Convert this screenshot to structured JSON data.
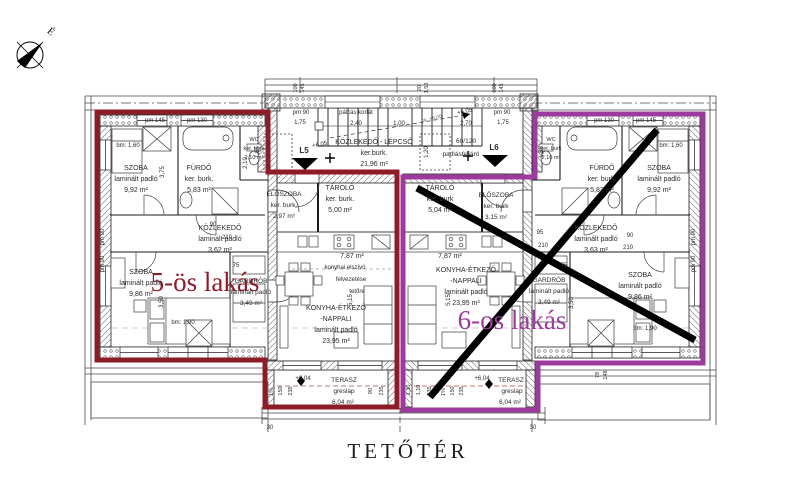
{
  "title": "TETŐTÉR",
  "compass": {
    "north_label": "É"
  },
  "plan": {
    "apartments": [
      {
        "id": "5",
        "label": "5-ös lakás",
        "color": "#8e1c27",
        "crossed_out": false,
        "rooms": [
          {
            "lines": [
              "SZOBA",
              "laminált padló",
              "9,92 m²"
            ],
            "x": 136,
            "y": 170
          },
          {
            "lines": [
              "FÜRDŐ",
              "ker. burk.",
              "5,83 m²"
            ],
            "x": 199,
            "y": 170
          },
          {
            "lines": [
              "WC",
              "ker. burk",
              "2,10 m²"
            ],
            "x": 254,
            "y": 141,
            "s": 5.5,
            "lh": 9
          },
          {
            "lines": [
              "KÖZLEKEDŐ",
              "laminált padló",
              "3,62 m²"
            ],
            "x": 220,
            "y": 230
          },
          {
            "lines": [
              "SZOBA",
              "laminált padló",
              "9,86 m²"
            ],
            "x": 141,
            "y": 274
          },
          {
            "lines": [
              "GARDRÓB",
              "laminált padló",
              "3,49 m²"
            ],
            "x": 251,
            "y": 283,
            "s": 6.5
          },
          {
            "lines": [
              "ELŐSZOBA",
              "ker. burk.",
              "2,97 m²"
            ],
            "x": 284,
            "y": 196,
            "s": 6.5
          },
          {
            "lines": [
              "TÁROLÓ",
              "ker. burk.",
              "5,00 m²"
            ],
            "x": 340,
            "y": 190
          },
          {
            "lines": [
              "KONYHA-ÉTKEZŐ",
              "-NAPPALI",
              "laminált padló",
              "23,95 m²"
            ],
            "x": 336,
            "y": 310
          }
        ]
      },
      {
        "id": "6",
        "label": "6-os lakás",
        "color": "#9c3a9d",
        "crossed_out": true,
        "cross_lines": [
          [
            417,
            188,
            695,
            340
          ],
          [
            657,
            130,
            430,
            397
          ]
        ],
        "rooms": [
          {
            "lines": [
              "WC",
              "ker. burk",
              "2,10 m²"
            ],
            "x": 551,
            "y": 141,
            "s": 5.5,
            "lh": 9
          },
          {
            "lines": [
              "FÜRDŐ",
              "ker. burk.",
              "5,83 m²"
            ],
            "x": 602,
            "y": 170
          },
          {
            "lines": [
              "SZOBA",
              "laminált padló",
              "9,92 m²"
            ],
            "x": 659,
            "y": 170
          },
          {
            "lines": [
              "KÖZLEKEDŐ",
              "laminált padló",
              "3,63 m²"
            ],
            "x": 596,
            "y": 230
          },
          {
            "lines": [
              "TÁROLÓ",
              "ker. burk",
              "5,04 m²"
            ],
            "x": 440,
            "y": 190
          },
          {
            "lines": [
              "ELŐSZOBA",
              "ker. burk",
              "3,15 m²"
            ],
            "x": 496,
            "y": 197,
            "s": 6.5
          },
          {
            "lines": [
              "KONYHA-ÉTKEZŐ",
              "-NAPPALI",
              "laminált padló",
              "23,95 m²"
            ],
            "x": 466,
            "y": 272
          },
          {
            "lines": [
              "GARDRÓB",
              "laminált padló",
              "3,49 m²"
            ],
            "x": 549,
            "y": 282,
            "s": 6.5
          },
          {
            "lines": [
              "SZOBA",
              "laminált padló",
              "9,86 m²"
            ],
            "x": 640,
            "y": 277
          }
        ]
      }
    ],
    "shared": {
      "rooms": [
        {
          "lines": [
            "KÖZLEKEDŐ - LÉPCSŐ",
            "ker.burk.",
            "21,96 m²"
          ],
          "x": 374,
          "y": 144
        }
      ]
    },
    "annotations": [
      {
        "t": "pálcás korlát",
        "x": 356,
        "y": 114,
        "s": 6
      },
      {
        "t": "2,40",
        "x": 356,
        "y": 125,
        "s": 6
      },
      {
        "t": "1,00",
        "x": 399,
        "y": 125,
        "s": 6
      },
      {
        "t": "2,70",
        "x": 466,
        "y": 125,
        "s": 6
      },
      {
        "t": "pm 90",
        "x": 301,
        "y": 114,
        "s": 6
      },
      {
        "t": "1,75",
        "x": 300,
        "y": 124,
        "s": 6
      },
      {
        "t": "pm 90",
        "x": 502,
        "y": 114,
        "s": 6
      },
      {
        "t": "1,75",
        "x": 503,
        "y": 124,
        "s": 6
      },
      {
        "t": "L5",
        "x": 304,
        "y": 153,
        "s": 8,
        "w": 1
      },
      {
        "t": "L6",
        "x": 494,
        "y": 150,
        "s": 8,
        "w": 1
      },
      {
        "t": "+6,05",
        "x": 320,
        "y": 146,
        "s": 6,
        "r": -10
      },
      {
        "t": "+6,05",
        "x": 465,
        "y": 113,
        "s": 6,
        "r": -12
      },
      {
        "t": "pk. +6,00",
        "x": 432,
        "y": 120,
        "s": 5,
        "r": -14,
        "c": "#666666"
      },
      {
        "t": "60/120",
        "x": 466,
        "y": 143,
        "s": 6.5
      },
      {
        "t": "padlásfeljáró",
        "x": 461,
        "y": 156,
        "s": 6.5
      },
      {
        "t": "1,55",
        "x": 259,
        "y": 152,
        "s": 6,
        "r": -90
      },
      {
        "t": "1,55",
        "x": 543,
        "y": 152,
        "s": 6,
        "r": -90
      },
      {
        "t": "1,20",
        "x": 428,
        "y": 152,
        "s": 6,
        "r": -90
      },
      {
        "t": "100",
        "x": 297,
        "y": 88,
        "s": 5.5,
        "r": -90
      },
      {
        "t": "145",
        "x": 304,
        "y": 88,
        "s": 5.5,
        "r": -90
      },
      {
        "t": "20",
        "x": 421,
        "y": 88,
        "s": 5.5,
        "r": -90
      },
      {
        "t": "1,50",
        "x": 428,
        "y": 88,
        "s": 5.5,
        "r": -90
      },
      {
        "t": "100",
        "x": 496,
        "y": 88,
        "s": 5.5,
        "r": -90
      },
      {
        "t": "145",
        "x": 503,
        "y": 88,
        "s": 5.5,
        "r": -90
      },
      {
        "t": "bm: 1,60",
        "x": 128,
        "y": 147,
        "s": 6
      },
      {
        "t": "pm 145",
        "x": 155,
        "y": 122,
        "s": 6
      },
      {
        "t": "pm 130",
        "x": 197,
        "y": 122,
        "s": 6
      },
      {
        "t": "pm 130",
        "x": 604,
        "y": 122,
        "s": 6
      },
      {
        "t": "pm 145",
        "x": 646,
        "y": 122,
        "s": 6
      },
      {
        "t": "bm: 1,60",
        "x": 671,
        "y": 147,
        "s": 6
      },
      {
        "t": "3,75",
        "x": 164,
        "y": 172,
        "s": 6,
        "r": -90
      },
      {
        "t": "2,10",
        "x": 247,
        "y": 163,
        "s": 6,
        "r": -90
      },
      {
        "t": "pm 90",
        "x": 104,
        "y": 237,
        "s": 6,
        "r": -90
      },
      {
        "t": "pm 90",
        "x": 104,
        "y": 264,
        "s": 6,
        "r": -90
      },
      {
        "t": "pm 90",
        "x": 695,
        "y": 237,
        "s": 6,
        "r": -90
      },
      {
        "t": "pm 90",
        "x": 695,
        "y": 264,
        "s": 6,
        "r": -90
      },
      {
        "t": "90",
        "x": 213,
        "y": 226,
        "s": 6
      },
      {
        "t": "210",
        "x": 227,
        "y": 239,
        "s": 6
      },
      {
        "t": "75",
        "x": 236,
        "y": 267,
        "s": 6
      },
      {
        "t": "90",
        "x": 630,
        "y": 237,
        "s": 6
      },
      {
        "t": "210",
        "x": 628,
        "y": 249,
        "s": 6
      },
      {
        "t": "95",
        "x": 540,
        "y": 234,
        "s": 6
      },
      {
        "t": "210",
        "x": 543,
        "y": 247,
        "s": 6
      },
      {
        "t": "75",
        "x": 564,
        "y": 267,
        "s": 6
      },
      {
        "t": "3,50",
        "x": 163,
        "y": 302,
        "s": 6,
        "r": -90
      },
      {
        "t": "bm: 1,90",
        "x": 183,
        "y": 324,
        "s": 6
      },
      {
        "t": "bm: 1,90",
        "x": 645,
        "y": 330,
        "s": 6
      },
      {
        "t": "3,50",
        "x": 573,
        "y": 303,
        "s": 6,
        "r": -90
      },
      {
        "t": "5,15",
        "x": 352,
        "y": 300,
        "s": 6,
        "r": -90
      },
      {
        "t": "5,15",
        "x": 450,
        "y": 300,
        "s": 6,
        "r": -90
      },
      {
        "t": "1%",
        "x": 273,
        "y": 392,
        "s": 5.5,
        "r": -90
      },
      {
        "t": "150",
        "x": 282,
        "y": 391,
        "s": 5.5,
        "r": -90
      },
      {
        "t": "235",
        "x": 292,
        "y": 391,
        "s": 5.5,
        "r": -90
      },
      {
        "t": "90",
        "x": 372,
        "y": 391,
        "s": 5.5,
        "r": -90
      },
      {
        "t": "235",
        "x": 383,
        "y": 391,
        "s": 5.5,
        "r": -90
      },
      {
        "t": "+6,04",
        "x": 303,
        "y": 380,
        "s": 6
      },
      {
        "t": "TERASZ",
        "x": 344,
        "y": 382,
        "s": 6.5
      },
      {
        "t": "greslap",
        "x": 344,
        "y": 393,
        "s": 6.5
      },
      {
        "t": "6,04 m²",
        "x": 343,
        "y": 404,
        "s": 6.5
      },
      {
        "t": "1,30",
        "x": 410,
        "y": 390,
        "s": 5.5,
        "r": -90
      },
      {
        "t": "1,10",
        "x": 420,
        "y": 390,
        "s": 5.5,
        "r": -90
      },
      {
        "t": "235",
        "x": 431,
        "y": 391,
        "s": 5.5,
        "r": -90
      },
      {
        "t": "1%",
        "x": 445,
        "y": 392,
        "s": 5.5,
        "r": -90
      },
      {
        "t": "150",
        "x": 454,
        "y": 391,
        "s": 5.5,
        "r": -90
      },
      {
        "t": "235",
        "x": 463,
        "y": 391,
        "s": 5.5,
        "r": -90
      },
      {
        "t": "+6,04",
        "x": 482,
        "y": 380,
        "s": 6
      },
      {
        "t": "TERASZ",
        "x": 511,
        "y": 382,
        "s": 6.5
      },
      {
        "t": "greslap",
        "x": 512,
        "y": 393,
        "s": 6.5
      },
      {
        "t": "6,04 m²",
        "x": 510,
        "y": 404,
        "s": 6.5
      },
      {
        "t": "30",
        "x": 270,
        "y": 429,
        "s": 6
      },
      {
        "t": "30",
        "x": 533,
        "y": 429,
        "s": 6
      },
      {
        "t": "78",
        "x": 599,
        "y": 375,
        "s": 5.5,
        "r": -90
      },
      {
        "t": "148",
        "x": 607,
        "y": 375,
        "s": 5.5,
        "r": -90
      },
      {
        "t": "konyhai elszívó",
        "x": 345,
        "y": 269,
        "s": 6
      },
      {
        "t": "felvezetése",
        "x": 351,
        "y": 281,
        "s": 6
      },
      {
        "t": "tetőre",
        "x": 357,
        "y": 293,
        "s": 6
      },
      {
        "t": "7,87 m²",
        "x": 352,
        "y": 258,
        "s": 7
      },
      {
        "t": "7,87 m²",
        "x": 450,
        "y": 258,
        "s": 7
      }
    ]
  }
}
